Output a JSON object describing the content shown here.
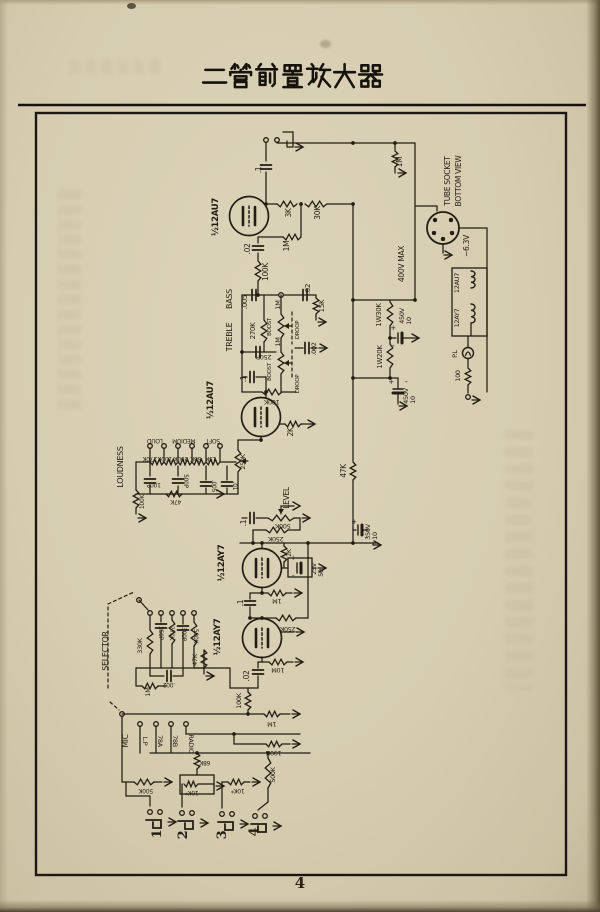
{
  "page": {
    "title": "二管前置放大器",
    "page_number": "4"
  },
  "schematic": {
    "labels": [
      {
        "t": ".1",
        "x": 261,
        "y": 170,
        "r": -90,
        "s": 7.5
      },
      {
        "t": "½12AU7",
        "x": 218,
        "y": 217,
        "r": -90,
        "s": 8.5,
        "b": 1
      },
      {
        "t": "3K",
        "x": 291,
        "y": 213,
        "r": -90,
        "s": 7.5
      },
      {
        "t": "30K",
        "x": 320,
        "y": 213,
        "r": -90,
        "s": 7.5
      },
      {
        "t": "1M",
        "x": 289,
        "y": 246,
        "r": -90,
        "s": 7.5
      },
      {
        "t": ".02",
        "x": 250,
        "y": 249,
        "r": -90,
        "s": 7.5
      },
      {
        "t": "100K",
        "x": 268,
        "y": 272,
        "r": -90,
        "s": 7.5
      },
      {
        "t": "1M",
        "x": 402,
        "y": 162,
        "r": -90,
        "s": 7.5
      },
      {
        "t": "BASS",
        "x": 232,
        "y": 299,
        "r": -90,
        "s": 8
      },
      {
        "t": "TREBLE",
        "x": 232,
        "y": 337,
        "r": -90,
        "s": 8
      },
      {
        "t": ".005",
        "x": 247,
        "y": 302,
        "r": -90,
        "s": 7
      },
      {
        "t": ".02",
        "x": 310,
        "y": 289,
        "r": -90,
        "s": 7
      },
      {
        "t": "15K",
        "x": 324,
        "y": 306,
        "r": -90,
        "s": 7
      },
      {
        "t": "270K",
        "x": 255,
        "y": 331,
        "r": -90,
        "s": 7
      },
      {
        "t": "BOOST",
        "x": 271,
        "y": 327,
        "r": -90,
        "s": 5.5
      },
      {
        "t": "1M",
        "x": 280,
        "y": 305,
        "r": -90,
        "s": 6.5
      },
      {
        "t": "DROOP",
        "x": 299,
        "y": 330,
        "r": -90,
        "s": 5.5
      },
      {
        "t": "250P",
        "x": 264,
        "y": 355,
        "r": 180,
        "s": 6.5
      },
      {
        "t": "BOOST",
        "x": 271,
        "y": 372,
        "r": -90,
        "s": 5.5
      },
      {
        "t": "1M",
        "x": 280,
        "y": 342,
        "r": -90,
        "s": 6.5
      },
      {
        "t": "DROOP",
        "x": 299,
        "y": 384,
        "r": -90,
        "s": 5.5
      },
      {
        "t": ".002",
        "x": 316,
        "y": 349,
        "r": -90,
        "s": 6.5
      },
      {
        "t": ".1",
        "x": 246,
        "y": 379,
        "r": -90,
        "s": 7.5
      },
      {
        "t": "100K",
        "x": 272,
        "y": 400,
        "r": 180,
        "s": 6.5
      },
      {
        "t": "½12AU7",
        "x": 213,
        "y": 400,
        "r": -90,
        "s": 8.5,
        "b": 1
      },
      {
        "t": "2K",
        "x": 293,
        "y": 432,
        "r": -90,
        "s": 7.5
      },
      {
        "t": "TUBE SOCKET",
        "x": 450,
        "y": 181,
        "r": -90,
        "s": 7.5
      },
      {
        "t": "BOTTOM VIEW",
        "x": 461,
        "y": 181,
        "r": -90,
        "s": 7.5
      },
      {
        "t": "~6.3V",
        "x": 469,
        "y": 246,
        "r": -90,
        "s": 7.5
      },
      {
        "t": "400V MAX",
        "x": 404,
        "y": 264,
        "r": -90,
        "s": 7.5
      },
      {
        "t": "1W30K",
        "x": 381,
        "y": 315,
        "r": -90,
        "s": 7
      },
      {
        "t": "450V",
        "x": 404,
        "y": 316,
        "r": -90,
        "s": 6.5
      },
      {
        "t": "10",
        "x": 411,
        "y": 321,
        "r": -90,
        "s": 6.5
      },
      {
        "t": "1W20K",
        "x": 382,
        "y": 357,
        "r": -90,
        "s": 7
      },
      {
        "t": "450V",
        "x": 408,
        "y": 396,
        "r": -90,
        "s": 6.5
      },
      {
        "t": "10",
        "x": 415,
        "y": 400,
        "r": -90,
        "s": 6.5
      },
      {
        "t": "12AU7",
        "x": 459,
        "y": 283,
        "r": -90,
        "s": 6.5
      },
      {
        "t": "12AY7",
        "x": 459,
        "y": 318,
        "r": -90,
        "s": 6.5
      },
      {
        "t": "P.L",
        "x": 457,
        "y": 354,
        "r": -90,
        "s": 6.5
      },
      {
        "t": "100",
        "x": 460,
        "y": 376,
        "r": -90,
        "s": 6.5
      },
      {
        "t": "LOUDNESS",
        "x": 123,
        "y": 467,
        "r": -90,
        "s": 8
      },
      {
        "t": "LOUD",
        "x": 155,
        "y": 439,
        "r": 180,
        "s": 6
      },
      {
        "t": "MEDIUM",
        "x": 184,
        "y": 439,
        "r": 180,
        "s": 6
      },
      {
        "t": "SOFT",
        "x": 213,
        "y": 439,
        "r": 180,
        "s": 6
      },
      {
        "t": "270K",
        "x": 150,
        "y": 457,
        "r": 180,
        "s": 6
      },
      {
        "t": "100K",
        "x": 165,
        "y": 457,
        "r": 180,
        "s": 6
      },
      {
        "t": "200K",
        "x": 181,
        "y": 457,
        "r": 180,
        "s": 6
      },
      {
        "t": "68K",
        "x": 196,
        "y": 457,
        "r": 180,
        "s": 6
      },
      {
        "t": "15K",
        "x": 211,
        "y": 457,
        "r": 180,
        "s": 6
      },
      {
        "t": "250K",
        "x": 245,
        "y": 462,
        "r": -90,
        "s": 6.5
      },
      {
        "t": "100P",
        "x": 154,
        "y": 483,
        "r": 180,
        "s": 6
      },
      {
        "t": "500P",
        "x": 184,
        "y": 481,
        "r": 90,
        "s": 6
      },
      {
        "t": ".005",
        "x": 212,
        "y": 486,
        "r": 90,
        "s": 6
      },
      {
        "t": ".01",
        "x": 233,
        "y": 486,
        "r": 90,
        "s": 6
      },
      {
        "t": "47K",
        "x": 176,
        "y": 500,
        "r": 180,
        "s": 6
      },
      {
        "t": "100K",
        "x": 144,
        "y": 502,
        "r": -90,
        "s": 6
      },
      {
        "t": "47K",
        "x": 346,
        "y": 471,
        "r": -90,
        "s": 7.5
      },
      {
        "t": "LEVEL",
        "x": 289,
        "y": 498,
        "r": -90,
        "s": 7.5
      },
      {
        "t": ".1",
        "x": 246,
        "y": 523,
        "r": -90,
        "s": 7.5
      },
      {
        "t": "500K",
        "x": 283,
        "y": 524,
        "r": 180,
        "s": 6.5
      },
      {
        "t": "250K",
        "x": 276,
        "y": 537,
        "r": 180,
        "s": 6.5
      },
      {
        "t": "2K",
        "x": 291,
        "y": 553,
        "r": -90,
        "s": 6.5
      },
      {
        "t": "25V",
        "x": 316,
        "y": 569,
        "r": -90,
        "s": 6.5
      },
      {
        "t": "50",
        "x": 323,
        "y": 573,
        "r": -90,
        "s": 6.5
      },
      {
        "t": "350V",
        "x": 370,
        "y": 532,
        "r": -90,
        "s": 6.5
      },
      {
        "t": "10",
        "x": 377,
        "y": 536,
        "r": -90,
        "s": 6.5
      },
      {
        "t": "½12AY7",
        "x": 224,
        "y": 563,
        "r": -90,
        "s": 8.5,
        "b": 1
      },
      {
        "t": "1M",
        "x": 277,
        "y": 599,
        "r": 180,
        "s": 6.5
      },
      {
        "t": ".1",
        "x": 243,
        "y": 603,
        "r": -90,
        "s": 7.5
      },
      {
        "t": "250K",
        "x": 288,
        "y": 627,
        "r": 180,
        "s": 6.5
      },
      {
        "t": "½12AY7",
        "x": 220,
        "y": 637,
        "r": -90,
        "s": 8.5,
        "b": 1
      },
      {
        "t": "10M",
        "x": 278,
        "y": 668,
        "r": 180,
        "s": 6.5
      },
      {
        "t": ".02",
        "x": 249,
        "y": 676,
        "r": -90,
        "s": 7.5
      },
      {
        "t": "47K",
        "x": 197,
        "y": 660,
        "r": -90,
        "s": 6.5
      },
      {
        "t": "SELECTOR",
        "x": 108,
        "y": 651,
        "r": -90,
        "s": 8
      },
      {
        "t": "330K",
        "x": 142,
        "y": 646,
        "r": -90,
        "s": 6.5
      },
      {
        "t": "250P",
        "x": 159,
        "y": 633,
        "r": 90,
        "s": 6
      },
      {
        "t": "270K",
        "x": 170,
        "y": 633,
        "r": 90,
        "s": 6
      },
      {
        "t": "300P",
        "x": 182,
        "y": 634,
        "r": 90,
        "s": 6
      },
      {
        "t": "500K",
        "x": 194,
        "y": 636,
        "r": 90,
        "s": 6
      },
      {
        "t": ".002",
        "x": 169,
        "y": 683,
        "r": 180,
        "s": 6
      },
      {
        "t": "1M",
        "x": 150,
        "y": 692,
        "r": -90,
        "s": 6.5
      },
      {
        "t": "100K",
        "x": 241,
        "y": 701,
        "r": -90,
        "s": 6.5
      },
      {
        "t": "MIC",
        "x": 128,
        "y": 741,
        "r": -90,
        "s": 7.5
      },
      {
        "t": "L.P",
        "x": 143,
        "y": 741,
        "r": 90,
        "s": 6.5
      },
      {
        "t": "78A",
        "x": 158,
        "y": 741,
        "r": 90,
        "s": 6.5
      },
      {
        "t": "78B",
        "x": 173,
        "y": 741,
        "r": 90,
        "s": 6.5
      },
      {
        "t": "RADIO",
        "x": 189,
        "y": 744,
        "r": 90,
        "s": 6.5
      },
      {
        "t": "500K",
        "x": 146,
        "y": 789,
        "r": 180,
        "s": 6
      },
      {
        "t": "68K",
        "x": 205,
        "y": 761,
        "r": 180,
        "s": 6
      },
      {
        "t": "10K*",
        "x": 192,
        "y": 791,
        "r": 180,
        "s": 6
      },
      {
        "t": "10K*",
        "x": 238,
        "y": 789,
        "r": 180,
        "s": 6
      },
      {
        "t": "500K",
        "x": 275,
        "y": 775,
        "r": -90,
        "s": 6.5
      },
      {
        "t": "1M",
        "x": 272,
        "y": 722,
        "r": 180,
        "s": 6.5
      },
      {
        "t": "100K",
        "x": 274,
        "y": 751,
        "r": 180,
        "s": 6.5
      },
      {
        "t": "+",
        "x": 354,
        "y": 524,
        "r": 0,
        "s": 7
      },
      {
        "t": "-",
        "x": 366,
        "y": 540,
        "r": 0,
        "s": 8
      },
      {
        "t": "+",
        "x": 393,
        "y": 330,
        "r": 0,
        "s": 7
      },
      {
        "t": "-",
        "x": 393,
        "y": 348,
        "r": 0,
        "s": 8
      },
      {
        "t": "+",
        "x": 391,
        "y": 384,
        "r": 0,
        "s": 7
      },
      {
        "t": "-",
        "x": 406,
        "y": 384,
        "r": 0,
        "s": 8
      },
      {
        "t": "+",
        "x": 293,
        "y": 560,
        "r": 0,
        "s": 7
      },
      {
        "t": "-",
        "x": 293,
        "y": 578,
        "r": 0,
        "s": 8
      },
      {
        "t": "1",
        "x": 161,
        "y": 834,
        "r": -90,
        "s": 13,
        "f": 1
      },
      {
        "t": "2",
        "x": 187,
        "y": 835,
        "r": -90,
        "s": 13,
        "f": 1
      },
      {
        "t": "3",
        "x": 226,
        "y": 835,
        "r": -90,
        "s": 13,
        "f": 1
      },
      {
        "t": "4",
        "x": 258,
        "y": 832,
        "r": -90,
        "s": 13,
        "f": 1
      }
    ]
  }
}
